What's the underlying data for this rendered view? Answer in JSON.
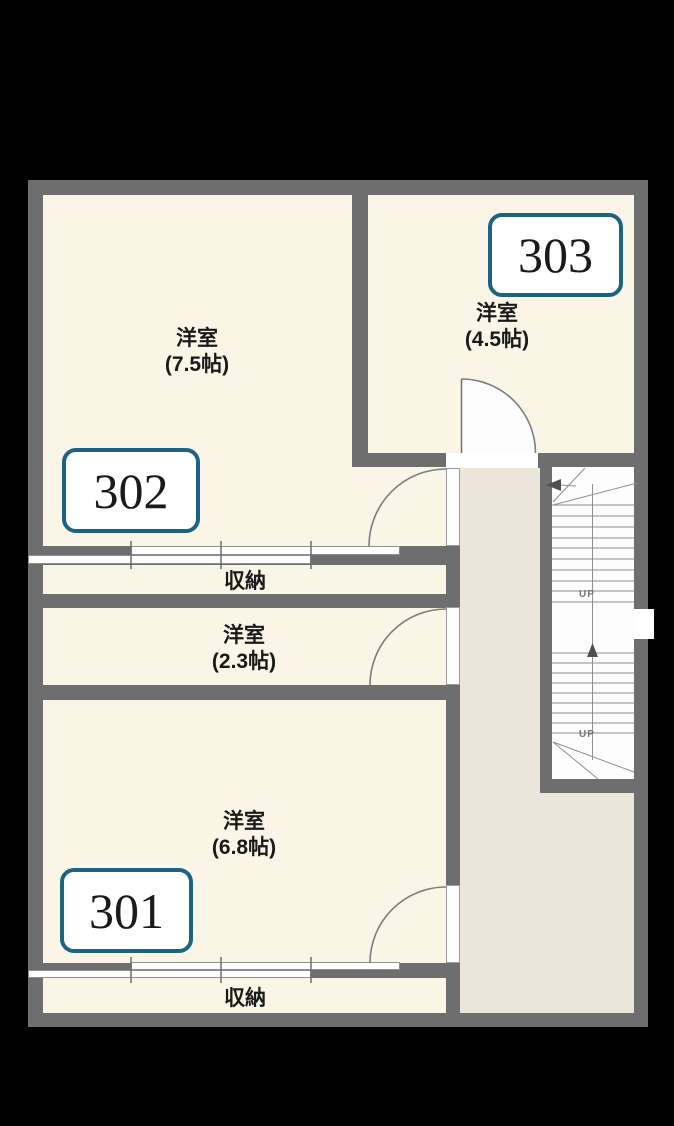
{
  "floorplan": {
    "background_color": "#000000",
    "wall_color": "#6e6e6e",
    "room_fill_color": "#faf5e6",
    "hallway_fill_color": "#ebe5da",
    "room_tag_border_color": "#1c6382",
    "rooms": {
      "r302": {
        "number": "302",
        "type": "洋室",
        "size": "(7.5帖)"
      },
      "r303": {
        "number": "303",
        "type": "洋室",
        "size": "(4.5帖)"
      },
      "r301": {
        "number": "301",
        "type": "洋室",
        "size": "(6.8帖)"
      },
      "small_room": {
        "type": "洋室",
        "size": "(2.3帖)"
      }
    },
    "closets": {
      "c302": "収納",
      "c301": "収納"
    },
    "stairs": {
      "up1": "UP",
      "up2": "UP"
    }
  }
}
